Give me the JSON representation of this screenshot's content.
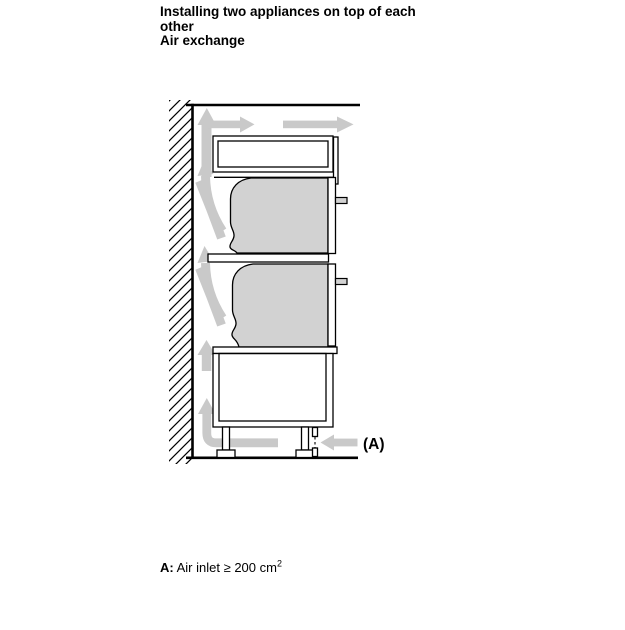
{
  "title": {
    "lines": [
      "Installing two appliances on top of each",
      "other",
      "Air exchange"
    ]
  },
  "caption": {
    "prefix": "A:",
    "body": " Air inlet ≥ 200 cm",
    "superscript": "2"
  },
  "diagram": {
    "label_a": "(A)",
    "colors": {
      "arrow_gray": "#c9c9c9",
      "appliance_fill": "#d2d2d2",
      "line_color": "#000000",
      "page_bg": "#ffffff",
      "text_color": "#000000"
    }
  }
}
